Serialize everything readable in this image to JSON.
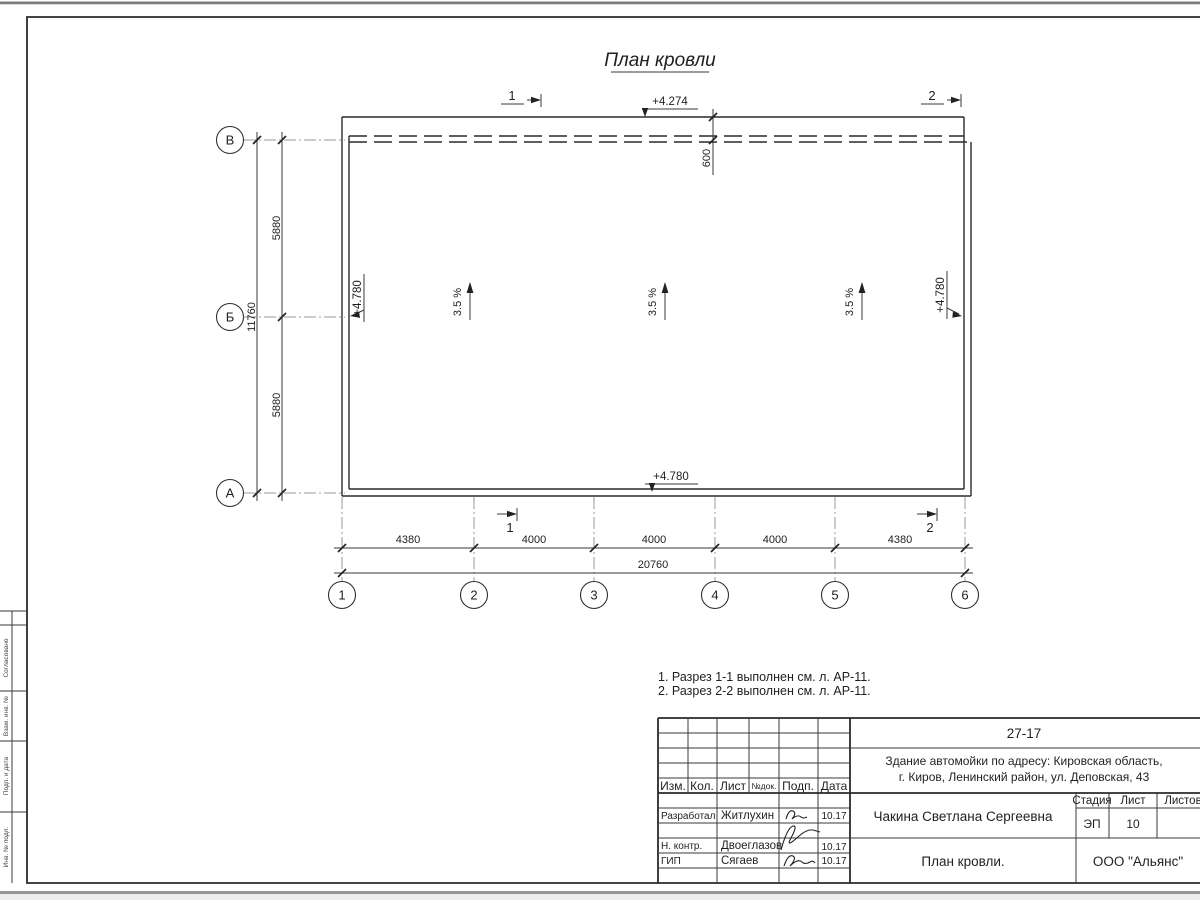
{
  "drawing": {
    "title": "План кровли",
    "axes": {
      "rows": [
        "В",
        "Б",
        "А"
      ],
      "cols": [
        "1",
        "2",
        "3",
        "4",
        "5",
        "6"
      ]
    },
    "dims": {
      "left_segments": [
        "5880",
        "5880"
      ],
      "left_total": "11760",
      "bottom_segments": [
        "4380",
        "4000",
        "4000",
        "4000",
        "4380"
      ],
      "bottom_total": "20760",
      "canopy_offset": "600"
    },
    "elevations": {
      "top": "+4.274",
      "left": "+4.780",
      "right": "+4.780",
      "bottom": "+4.780"
    },
    "slope_label": "3.5 %",
    "section_1": "1",
    "section_2": "2"
  },
  "notes": {
    "line1": "1. Разрез 1-1 выполнен см. л. АР-11.",
    "line2": "2. Разрез 2-2 выполнен см. л. АР-11."
  },
  "title_block": {
    "doc_number": "27-17",
    "project_address_line1": "Здание автомойки по адресу: Кировская область,",
    "project_address_line2": "г. Киров, Ленинский район, ул. Деповская, 43",
    "columns": [
      "Изм.",
      "Кол.",
      "Лист",
      "№док.",
      "Подп.",
      "Дата"
    ],
    "roles": {
      "developer": "Разработал",
      "norm_control": "Н. контр.",
      "gip": "ГИП"
    },
    "names": {
      "developer": "Житлухин",
      "norm_control": "Двоеглазов",
      "gip": "Сягаев"
    },
    "dates": {
      "developer": "10.17",
      "norm_control": "10.17",
      "gip": "10.17"
    },
    "author": "Чакина Светлана Сергеевна",
    "sheet_name": "План кровли.",
    "company": "ООО \"Альянс\"",
    "stage_label": "Стадия",
    "sheet_label": "Лист",
    "sheets_label": "Листов",
    "stage_value": "ЭП",
    "sheet_value": "10"
  },
  "side_stamp": {
    "agreed": "Согласовано",
    "cell1": "Взам. инв. №",
    "cell2": "Подп. и дата",
    "cell3": "Инв. № подл."
  }
}
